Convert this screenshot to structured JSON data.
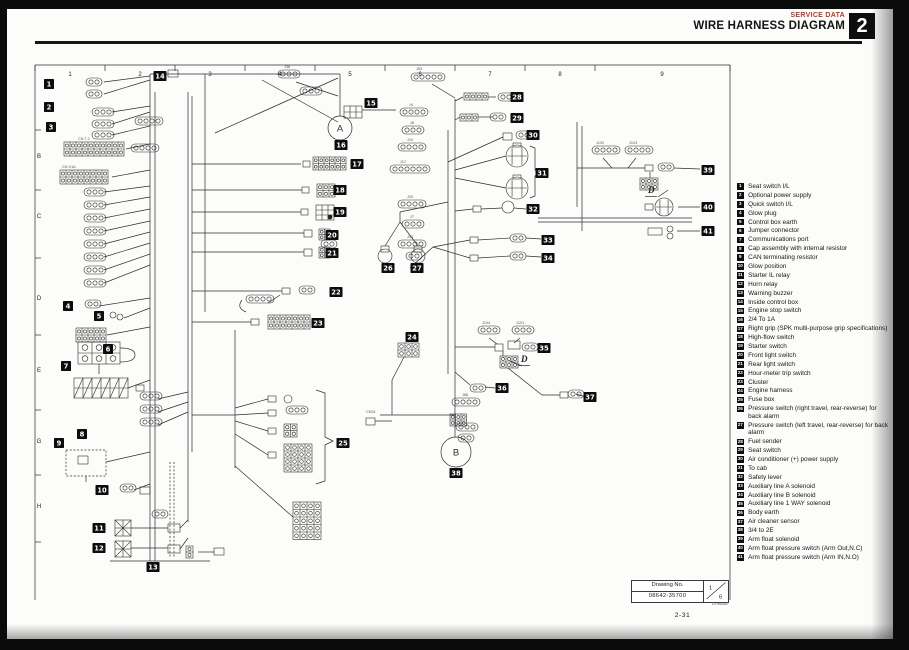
{
  "header": {
    "section": "SERVICE DATA",
    "title": "WIRE HARNESS DIAGRAM",
    "chapter": "2"
  },
  "legend": {
    "items": [
      {
        "n": "1",
        "text": "Seat switch I/L"
      },
      {
        "n": "2",
        "text": "Optional power supply"
      },
      {
        "n": "3",
        "text": "Quick switch I/L"
      },
      {
        "n": "4",
        "text": "Glow plug"
      },
      {
        "n": "5",
        "text": "Control box earth"
      },
      {
        "n": "6",
        "text": "Jumper connector"
      },
      {
        "n": "7",
        "text": "Communications port"
      },
      {
        "n": "8",
        "text": "Cap assembly with internal resistor"
      },
      {
        "n": "9",
        "text": "CAN terminating resistor"
      },
      {
        "n": "10",
        "text": "Glow position"
      },
      {
        "n": "11",
        "text": "Starter IL relay"
      },
      {
        "n": "12",
        "text": "Horn relay"
      },
      {
        "n": "13",
        "text": "Warning buzzer"
      },
      {
        "n": "14",
        "text": "Inside control box"
      },
      {
        "n": "15",
        "text": "Engine stop switch"
      },
      {
        "n": "16",
        "text": "2/4  To 1A"
      },
      {
        "n": "17",
        "text": "Right grip (SPK multi-purpose grip specifications)"
      },
      {
        "n": "18",
        "text": "High-flow switch"
      },
      {
        "n": "19",
        "text": "Starter switch"
      },
      {
        "n": "20",
        "text": "Front light switch"
      },
      {
        "n": "21",
        "text": "Rear light switch"
      },
      {
        "n": "22",
        "text": "Hour-meter trip switch"
      },
      {
        "n": "23",
        "text": "Cluster"
      },
      {
        "n": "24",
        "text": "Engine harness"
      },
      {
        "n": "25",
        "text": "Fuse box"
      },
      {
        "n": "26",
        "text": "Pressure switch (right travel, rear-reverse) for back alarm"
      },
      {
        "n": "27",
        "text": "Pressure switch (left travel, rear-reverse) for back alarm"
      },
      {
        "n": "28",
        "text": "Fuel sender"
      },
      {
        "n": "29",
        "text": "Seat switch"
      },
      {
        "n": "30",
        "text": "Air conditioner (+) power supply"
      },
      {
        "n": "31",
        "text": "To cab"
      },
      {
        "n": "32",
        "text": "Safety lever"
      },
      {
        "n": "33",
        "text": "Auxiliary line A solenoid"
      },
      {
        "n": "34",
        "text": "Auxiliary line B solenoid"
      },
      {
        "n": "35",
        "text": "Auxiliary line 1 WAY solenoid"
      },
      {
        "n": "36",
        "text": "Body earth"
      },
      {
        "n": "37",
        "text": "Air cleaner sensor"
      },
      {
        "n": "38",
        "text": "3/4  to 2E"
      },
      {
        "n": "39",
        "text": "Arm float solenoid"
      },
      {
        "n": "40",
        "text": "Arm float pressure switch (Arm Out,N.C)"
      },
      {
        "n": "41",
        "text": "Arm float pressure switch (Arm IN,N.O)"
      }
    ]
  },
  "diagram": {
    "columns": [
      "1",
      "2",
      "3",
      "4",
      "5",
      "6",
      "7",
      "8",
      "9"
    ],
    "column_x": [
      70,
      140,
      210,
      280,
      350,
      420,
      490,
      560,
      662
    ],
    "rows": [
      "B",
      "C",
      "D",
      "E",
      "G",
      "H"
    ],
    "row_y": [
      158,
      218,
      300,
      372,
      443,
      508
    ],
    "badges": [
      {
        "n": "1",
        "x": 49,
        "y": 84
      },
      {
        "n": "2",
        "x": 49,
        "y": 107
      },
      {
        "n": "3",
        "x": 51,
        "y": 127
      },
      {
        "n": "4",
        "x": 68,
        "y": 306
      },
      {
        "n": "5",
        "x": 99,
        "y": 316
      },
      {
        "n": "6",
        "x": 108,
        "y": 349
      },
      {
        "n": "7",
        "x": 66,
        "y": 366
      },
      {
        "n": "8",
        "x": 82,
        "y": 434
      },
      {
        "n": "9",
        "x": 59,
        "y": 443
      },
      {
        "n": "10",
        "x": 102,
        "y": 490
      },
      {
        "n": "11",
        "x": 99,
        "y": 528
      },
      {
        "n": "12",
        "x": 99,
        "y": 548
      },
      {
        "n": "13",
        "x": 153,
        "y": 567
      },
      {
        "n": "14",
        "x": 160,
        "y": 76
      },
      {
        "n": "15",
        "x": 371,
        "y": 103
      },
      {
        "n": "16",
        "x": 341,
        "y": 145
      },
      {
        "n": "17",
        "x": 357,
        "y": 164
      },
      {
        "n": "18",
        "x": 340,
        "y": 190
      },
      {
        "n": "19",
        "x": 340,
        "y": 212
      },
      {
        "n": "20",
        "x": 332,
        "y": 235
      },
      {
        "n": "21",
        "x": 332,
        "y": 253
      },
      {
        "n": "22",
        "x": 336,
        "y": 292
      },
      {
        "n": "23",
        "x": 318,
        "y": 323
      },
      {
        "n": "24",
        "x": 412,
        "y": 337
      },
      {
        "n": "25",
        "x": 343,
        "y": 443
      },
      {
        "n": "26",
        "x": 388,
        "y": 268
      },
      {
        "n": "27",
        "x": 417,
        "y": 268
      },
      {
        "n": "28",
        "x": 517,
        "y": 97
      },
      {
        "n": "29",
        "x": 517,
        "y": 118
      },
      {
        "n": "30",
        "x": 533,
        "y": 135
      },
      {
        "n": "31",
        "x": 542,
        "y": 173
      },
      {
        "n": "32",
        "x": 533,
        "y": 209
      },
      {
        "n": "33",
        "x": 548,
        "y": 240
      },
      {
        "n": "34",
        "x": 548,
        "y": 258
      },
      {
        "n": "35",
        "x": 544,
        "y": 348
      },
      {
        "n": "36",
        "x": 502,
        "y": 388
      },
      {
        "n": "37",
        "x": 590,
        "y": 397
      },
      {
        "n": "38",
        "x": 456,
        "y": 473
      },
      {
        "n": "39",
        "x": 708,
        "y": 170
      },
      {
        "n": "40",
        "x": 708,
        "y": 207
      },
      {
        "n": "41",
        "x": 708,
        "y": 231
      }
    ],
    "ref_circles": [
      {
        "label": "A",
        "x": 340,
        "y": 128,
        "r": 12
      },
      {
        "label": "B",
        "x": 456,
        "y": 452,
        "r": 15
      }
    ],
    "d_markers": [
      {
        "label": "D",
        "x": 521,
        "y": 362
      },
      {
        "label": "D",
        "x": 648,
        "y": 193
      }
    ],
    "labels": [
      {
        "t": "J38",
        "x": 284,
        "y": 68
      },
      {
        "t": "J53",
        "x": 416,
        "y": 70
      },
      {
        "t": "J4",
        "x": 409,
        "y": 106
      },
      {
        "t": "J8",
        "x": 410,
        "y": 124
      },
      {
        "t": "J10",
        "x": 407,
        "y": 141
      },
      {
        "t": "J17",
        "x": 400,
        "y": 163
      },
      {
        "t": "J20",
        "x": 407,
        "y": 198
      },
      {
        "t": "J7",
        "x": 410,
        "y": 218
      },
      {
        "t": "J13",
        "x": 407,
        "y": 238
      },
      {
        "t": "J104",
        "x": 482,
        "y": 324
      },
      {
        "t": "J101",
        "x": 516,
        "y": 324
      },
      {
        "t": "J102",
        "x": 596,
        "y": 144
      },
      {
        "t": "J103",
        "x": 629,
        "y": 144
      },
      {
        "t": "J66",
        "x": 462,
        "y": 396
      },
      {
        "t": "CN31",
        "x": 366,
        "y": 413
      },
      {
        "t": "CN 7-1",
        "x": 78,
        "y": 140
      },
      {
        "t": "CN X1A",
        "x": 62,
        "y": 168
      }
    ]
  },
  "drawing_box": {
    "label": "Drawing No.",
    "number": "08642-35700",
    "sheet_no": "1",
    "sheet_total": "6",
    "code": "DY9M082"
  },
  "page_number": "2-31"
}
